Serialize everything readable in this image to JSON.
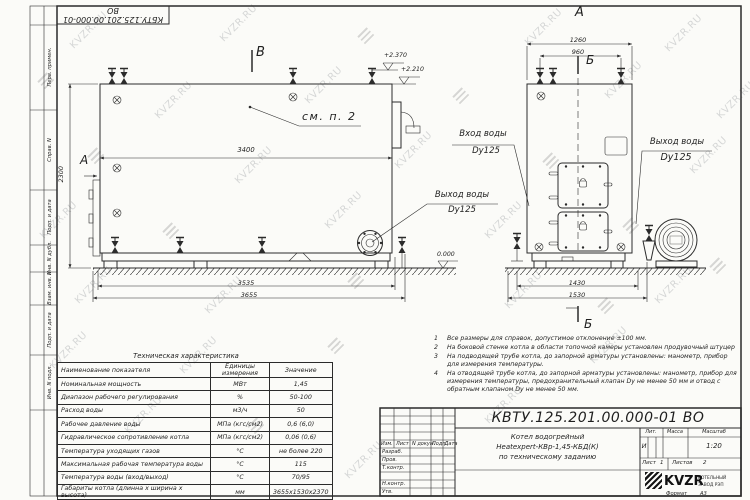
{
  "watermark": {
    "text": "KVZR.RU"
  },
  "stamp_top": "КБТУ.125.201.00.000-01 ВО",
  "side_margin": {
    "fields": [
      "Перв. примен.",
      "Справ. N",
      "Подп. и дата",
      "Инв. N дубл.",
      "Взам. инв. N",
      "Подп. и дата",
      "Инв. N подл."
    ]
  },
  "main_view": {
    "section_b": "В",
    "view_a": "А",
    "see_note": "см. п. 2",
    "dim_3400": "3400",
    "dim_2300": "2300",
    "dim_3535": "3535",
    "dim_3655": "3655",
    "elev_1": "+2.370",
    "elev_2": "+2.210",
    "elev_0": "0.000",
    "outlet_line1": "Выход воды",
    "outlet_line2": "Dy125"
  },
  "front_view": {
    "view_a": "А",
    "section_b_top": "Б",
    "section_b_bottom": "Б",
    "dim_1260": "1260",
    "dim_960": "960",
    "dim_1430": "1430",
    "dim_1530": "1530",
    "inlet_line1": "Вход воды",
    "inlet_line2": "Dy125",
    "outlet_line1": "Выход воды",
    "outlet_line2": "Dy125"
  },
  "notes": [
    {
      "num": "1",
      "text": "Все размеры для справок, допустимое отклонение ±100 мм."
    },
    {
      "num": "2",
      "text": "На боковой стенке котла в области топочной камеры установлен продувочный штуцер"
    },
    {
      "num": "3",
      "text": "На подводящей трубе котла, до запорной арматуры установлены: манометр, прибор для измерения температуры."
    },
    {
      "num": "4",
      "text": "На отводящей трубе котла, до запорной арматуры установлены: манометр, прибор для измерения температуры, предохранительный клапан Dу не менее 50 мм и отвод с обратным клапаном Dу не менее 50 мм."
    }
  ],
  "spec_table": {
    "title": "Техническая характеристика",
    "headers": [
      "Наименование показателя",
      "Единицы измерения",
      "Значение"
    ],
    "rows": [
      [
        "Номинальная мощность",
        "МВт",
        "1,45"
      ],
      [
        "Диапазон рабочего регулирования",
        "%",
        "50-100"
      ],
      [
        "Расход воды",
        "м3/ч",
        "50"
      ],
      [
        "Рабочее давление воды",
        "МПа (кгс/см2)",
        "0,6 (6,0)"
      ],
      [
        "Гидравлическое сопротивление котла",
        "МПа (кгс/см2)",
        "0,06 (0,6)"
      ],
      [
        "Температура уходящих газов",
        "°С",
        "не более 220"
      ],
      [
        "Максимальная рабочая температура воды",
        "°С",
        "115"
      ],
      [
        "Температура воды (вход/выход)",
        "°С",
        "70/95"
      ],
      [
        "Габариты котла (длинна х ширина х высота)",
        "мм",
        "3655х1530х2370"
      ]
    ]
  },
  "title_block": {
    "designation": "КВТУ.125.201.00.000-01 ВО",
    "change_headers": [
      "Изм.",
      "Лист",
      "N докум.",
      "Подп.",
      "Дата"
    ],
    "roles": [
      "Разраб.",
      "Пров.",
      "Т.контр.",
      "Н.контр.",
      "Утв."
    ],
    "title_line1": "Котел водогрейный",
    "title_line2": "Heatexpert-КВр-1,45-КБД(К)",
    "title_line3": "по техническому заданию",
    "lit_header": "Лит.",
    "mass_header": "Масса",
    "scale_header": "Масштаб",
    "lit_value": "И",
    "scale_value": "1:20",
    "sheet_label": "Лист",
    "sheet_value": "1",
    "sheets_label": "Листов",
    "sheets_value": "2",
    "logo_text": "KVZR",
    "company_line1": "КОТЕЛЬНЫЙ",
    "company_line2": "ЗАВОД РЭП",
    "format_label": "Формат",
    "format_value": "А3"
  }
}
